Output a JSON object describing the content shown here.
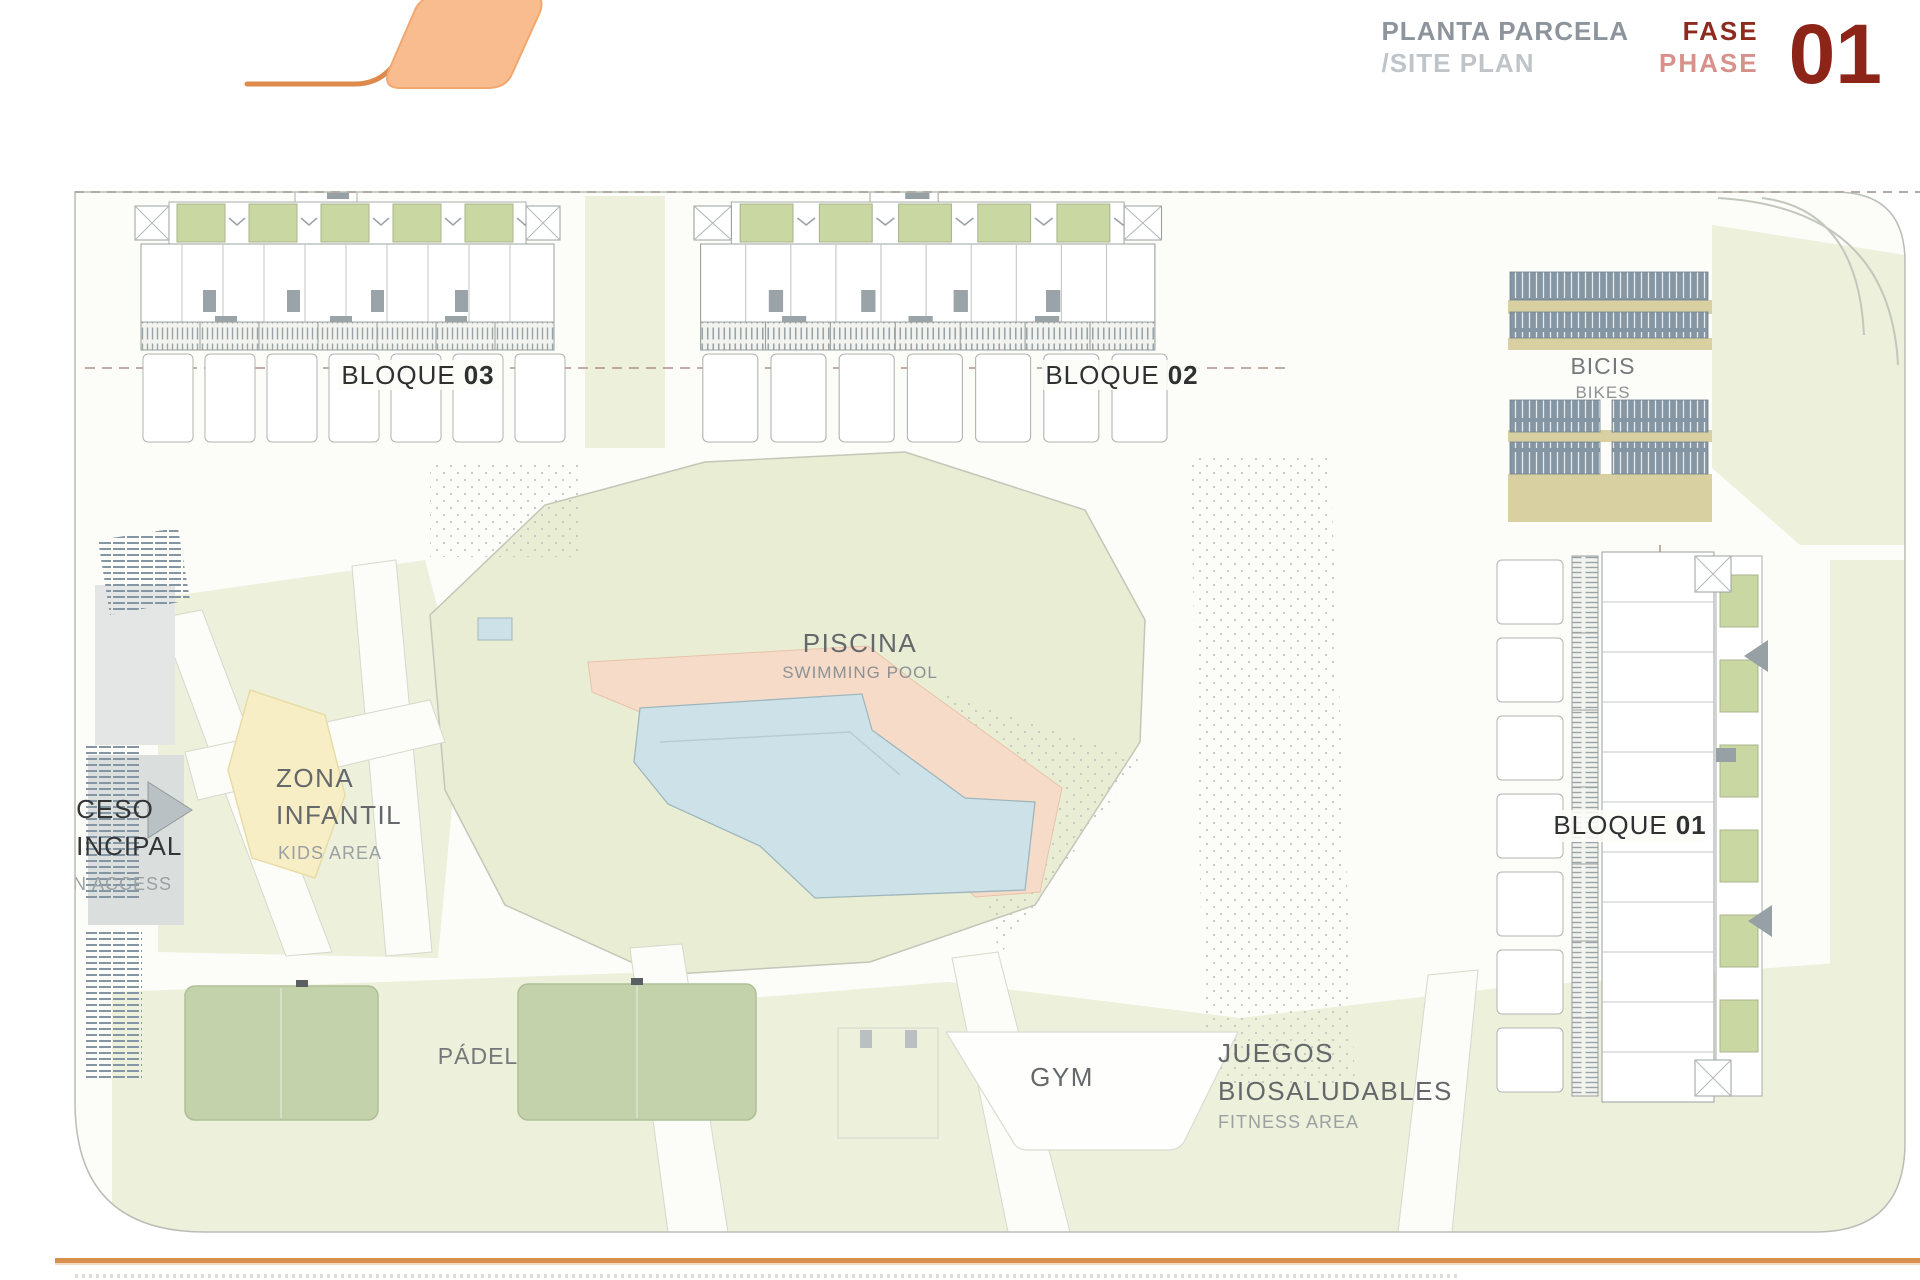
{
  "header": {
    "title_primary": "PLANTA PARCELA",
    "title_secondary": "/SITE PLAN",
    "phase_word_es": "FASE",
    "phase_word_en": "PHASE",
    "phase_number": "01"
  },
  "plan": {
    "blocks": [
      {
        "name_prefix": "BLOQUE",
        "number": "03"
      },
      {
        "name_prefix": "BLOQUE",
        "number": "02"
      },
      {
        "name_prefix": "BLOQUE",
        "number": "01"
      }
    ],
    "labels": {
      "pool_es": "PISCINA",
      "pool_en": "SWIMMING POOL",
      "kids_line1": "ZONA",
      "kids_line2": "INFANTIL",
      "kids_en": "KIDS AREA",
      "access_line1": "ACCESO",
      "access_line2": "PRINCIPAL",
      "access_en": "MAIN ACCESS",
      "bikes_es": "BICIS",
      "bikes_en": "BIKES",
      "padel": "PÁDEL",
      "gym": "GYM",
      "fitness_line1": "JUEGOS",
      "fitness_line2": "BIOSALUDABLES",
      "fitness_en": "FITNESS AREA"
    }
  },
  "colors": {
    "brand_orange_fill": "#f8bc8e",
    "brand_orange_stroke": "#dd8a4c",
    "phase_dark_red": "#8c2418",
    "phase_light_red": "#d8918a",
    "title_gray": "#8d949b",
    "title_light_gray": "#bfc4c9",
    "ground_green": "#edf0da",
    "patio_green": "#c9d8a2",
    "pool_blue": "#cde2e8",
    "pool_deck_salmon": "#f6dcc8",
    "kids_yellow": "#f8eec6",
    "rack_slate": "#8495a4",
    "rack_khaki": "#d9d0a2",
    "bottom_line_orange": "#d78f4e"
  }
}
